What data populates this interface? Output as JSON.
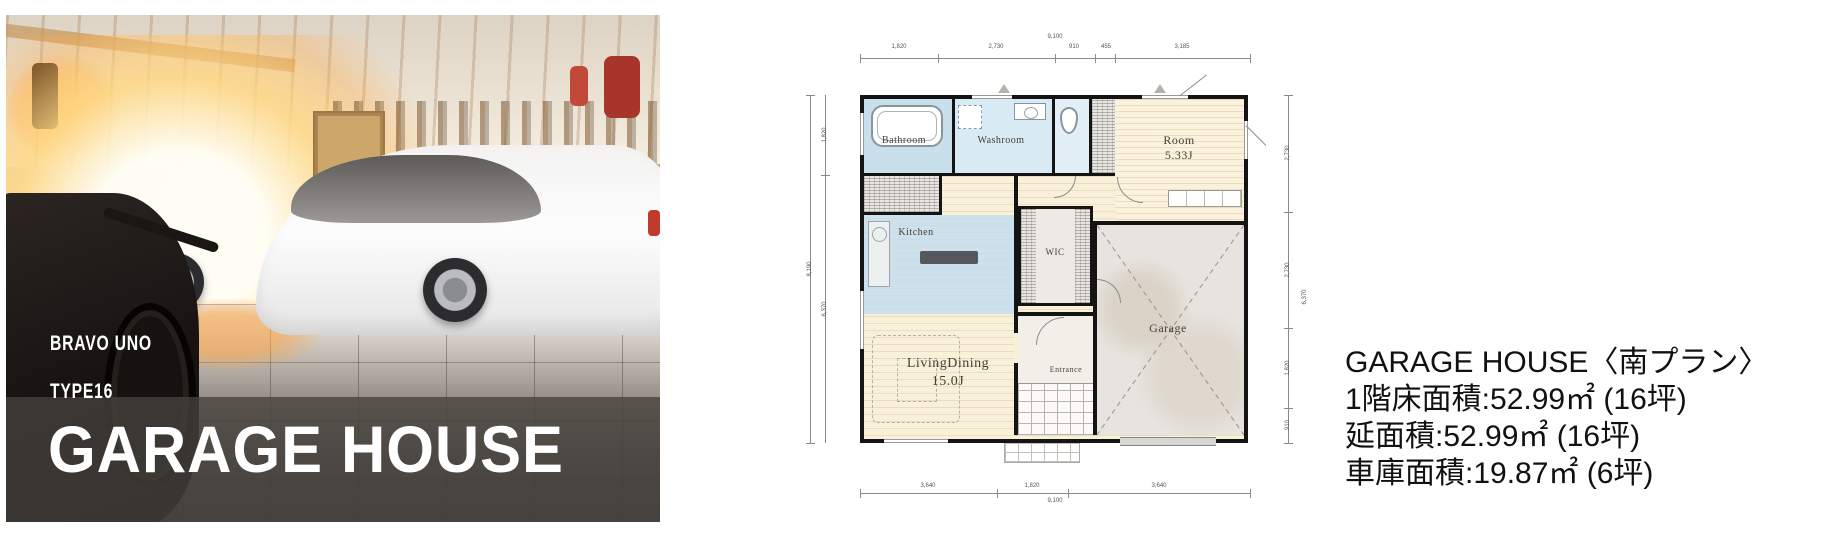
{
  "hero": {
    "brand": "BRAVO UNO",
    "type_label": "TYPE16",
    "title": "GARAGE HOUSE"
  },
  "floor_plan": {
    "rooms": {
      "bathroom": {
        "label": "Bathroom"
      },
      "washroom": {
        "label": "Washroom"
      },
      "room": {
        "label": "Room",
        "area": "5.33J"
      },
      "kitchen": {
        "label": "Kitchen"
      },
      "wic": {
        "label": "WIC"
      },
      "living_dining": {
        "label": "LivingDining",
        "area": "15.0J"
      },
      "entrance": {
        "label": "Entrance"
      },
      "garage": {
        "label": "Garage"
      }
    },
    "dimensions": {
      "top": {
        "total": "9,100",
        "segments": [
          "1,820",
          "2,730",
          "910",
          "455",
          "3,185"
        ]
      },
      "bottom": {
        "total": "9,100",
        "segments": [
          "3,640",
          "1,820",
          "3,640"
        ]
      },
      "left": {
        "total": "8,190",
        "segments": [
          "1,820",
          "6,370"
        ]
      },
      "right": {
        "total": "6,370",
        "segments": [
          "2,730",
          "2,730",
          "1,820",
          "910"
        ]
      }
    }
  },
  "info": {
    "title": "GARAGE HOUSE〈南プラン〉",
    "floor1_area": "1階床面積:52.99㎡ (16坪)",
    "total_area": "延面積:52.99㎡ (16坪)",
    "garage_area": "車庫面積:19.87㎡ (6坪)"
  }
}
